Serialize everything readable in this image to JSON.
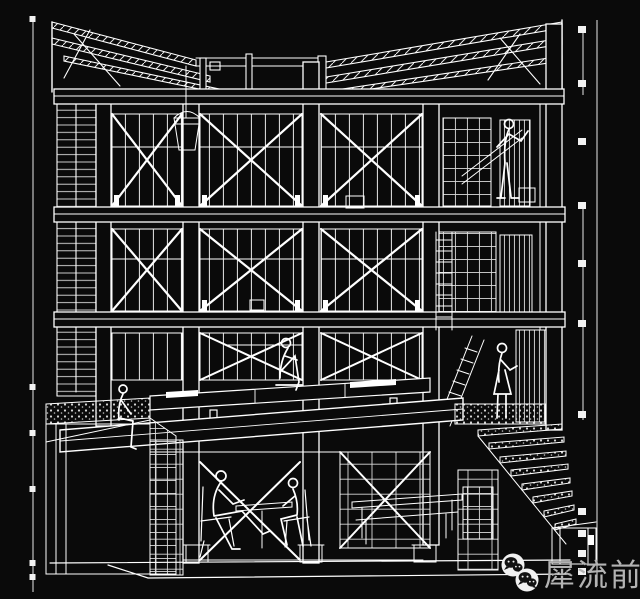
{
  "page": {
    "background": "#0a0a0a",
    "ink": "#ffffff"
  },
  "watermark": {
    "text": "犀流前报",
    "color": "#b3b3b3",
    "icon": "wechat-logo"
  },
  "scene": {
    "type": "wireframe-sectional-perspective",
    "subject": "three-storey cross-braced timber frame building with butterfly roof, mezzanine platform, basement seating and side stairs",
    "people_count": 6
  }
}
